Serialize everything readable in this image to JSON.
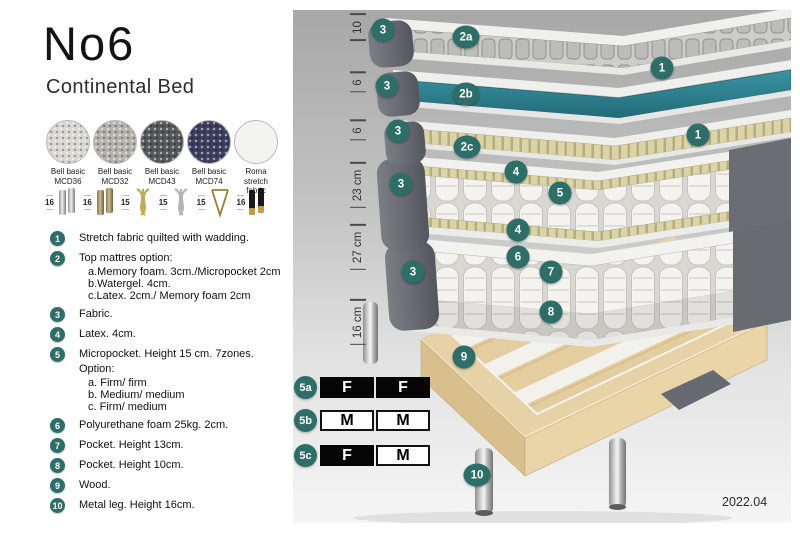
{
  "header": {
    "title": "No6",
    "subtitle": "Continental Bed"
  },
  "fabrics": {
    "items": [
      {
        "line1": "Bell basic",
        "line2": "MCD36",
        "color": "#d9d7d1"
      },
      {
        "line1": "Bell basic",
        "line2": "MCD32",
        "color": "#b4b2ad"
      },
      {
        "line1": "Bell basic",
        "line2": "MCD43",
        "color": "#57585a"
      },
      {
        "line1": "Bell basic",
        "line2": "MCD74",
        "color": "#3c405e"
      },
      {
        "line1": "Roma",
        "line2": "stretch fabric",
        "color": "#f3f3f1"
      }
    ]
  },
  "legs": {
    "items": [
      {
        "height": "16",
        "style": "chrome-cylinder-pair"
      },
      {
        "height": "16",
        "style": "bronze-cylinder-pair"
      },
      {
        "height": "15",
        "style": "gold-twist"
      },
      {
        "height": "15",
        "style": "silver-twist"
      },
      {
        "height": "15",
        "style": "gold-hairpin"
      },
      {
        "height": "16",
        "style": "black-gold-cylinder-pair"
      }
    ]
  },
  "features": {
    "items": [
      {
        "num": "1",
        "text": "Stretch fabric quilted with wadding."
      },
      {
        "num": "2",
        "text": "Top mattres option:",
        "subs": [
          "a.Memory foam. 3cm./Micropocket 2cm",
          "b.Watergel. 4cm.",
          "c.Latex. 2cm./ Memory foam 2cm"
        ]
      },
      {
        "num": "3",
        "text": "Fabric."
      },
      {
        "num": "4",
        "text": "Latex. 4cm."
      },
      {
        "num": "5",
        "text": "Micropocket. Height 15 cm. 7zones. Option:",
        "subs": [
          "a. Firm/ firm",
          "b. Medium/ medium",
          "c. Firm/ medium"
        ]
      },
      {
        "num": "6",
        "text": "Polyurethane foam 25kg. 2cm."
      },
      {
        "num": "7",
        "text": "Pocket. Height 13cm."
      },
      {
        "num": "8",
        "text": "Pocket. Height 10cm."
      },
      {
        "num": "9",
        "text": "Wood."
      },
      {
        "num": "10",
        "text": "Metal leg. Height 16cm."
      }
    ]
  },
  "diagram": {
    "measurements": [
      {
        "label": "10"
      },
      {
        "label": "6"
      },
      {
        "label": "6"
      },
      {
        "label": "23 cm"
      },
      {
        "label": "27 cm"
      },
      {
        "label": "16 cm"
      }
    ],
    "callouts": [
      {
        "label": "3"
      },
      {
        "label": "2a"
      },
      {
        "label": "1"
      },
      {
        "label": "3"
      },
      {
        "label": "2b"
      },
      {
        "label": "1"
      },
      {
        "label": "3"
      },
      {
        "label": "2c"
      },
      {
        "label": "4"
      },
      {
        "label": "3"
      },
      {
        "label": "5"
      },
      {
        "label": "4"
      },
      {
        "label": "6"
      },
      {
        "label": "3"
      },
      {
        "label": "7"
      },
      {
        "label": "8"
      },
      {
        "label": "9"
      },
      {
        "label": "10"
      }
    ],
    "firmness": {
      "rows": [
        {
          "label": "5a",
          "cells": [
            {
              "text": "F",
              "variant": "dark"
            },
            {
              "text": "F",
              "variant": "dark"
            }
          ]
        },
        {
          "label": "5b",
          "cells": [
            {
              "text": "M",
              "variant": "light"
            },
            {
              "text": "M",
              "variant": "light"
            }
          ]
        },
        {
          "label": "5c",
          "cells": [
            {
              "text": "F",
              "variant": "dark"
            },
            {
              "text": "M",
              "variant": "light"
            }
          ]
        }
      ]
    },
    "version": "2022.04"
  },
  "colors": {
    "badge_teal": "#2e6e68",
    "watergel_teal": "#2b7e8d",
    "latex_tan": "#d9d2a4",
    "fabric_gray": "#6b6d75",
    "wood": "#e3cc9d"
  }
}
